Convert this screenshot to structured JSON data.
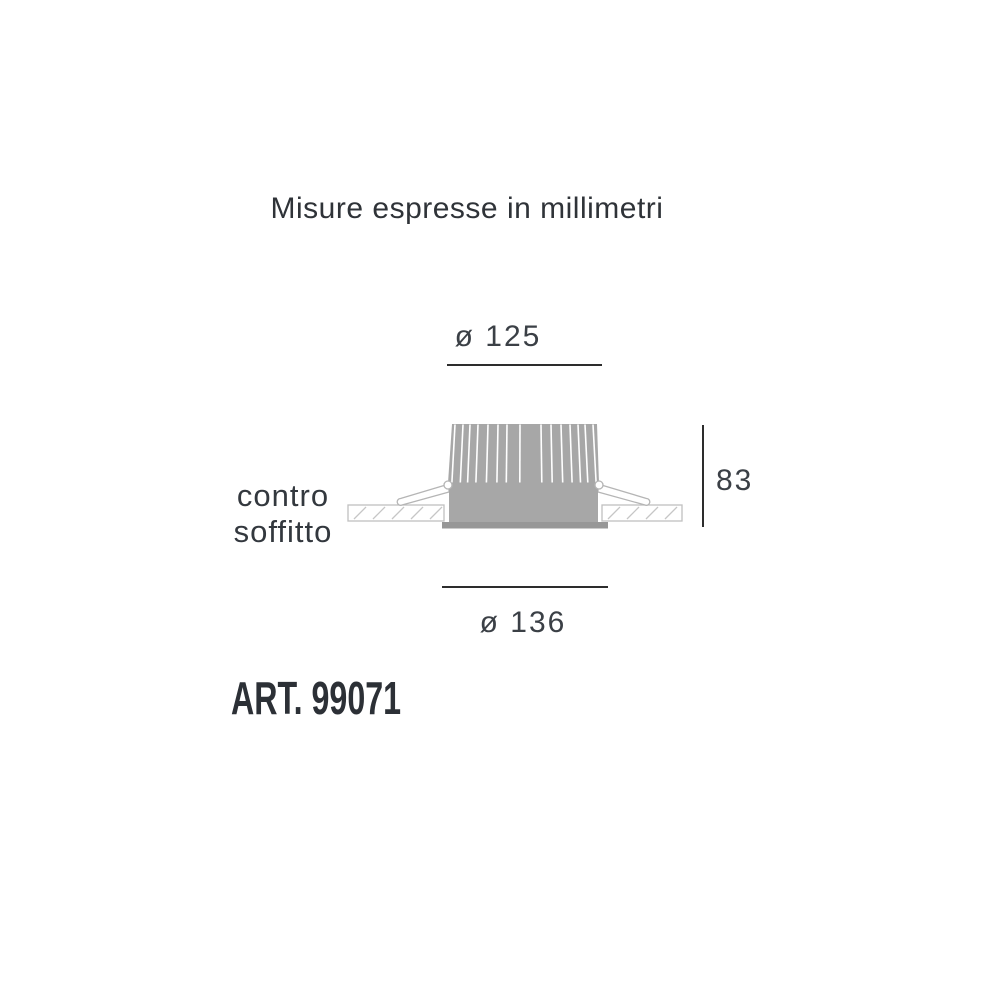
{
  "title": "Misure espresse in millimetri",
  "diagram": {
    "type": "technical-drawing",
    "subject": "recessed-downlight-cross-section",
    "dimensions": {
      "top_diameter": "ø 125",
      "height": "83",
      "bottom_diameter": "ø 136",
      "units": "millimetri"
    },
    "labels": {
      "ceiling_line1": "contro",
      "ceiling_line2": "soffitto"
    }
  },
  "article": {
    "label": "ART. 99071"
  },
  "colors": {
    "background": "#ffffff",
    "text": "#3b4046",
    "dimension_line": "#2d2d2d",
    "fixture_gray": "#a7a7a7",
    "flange_gray": "#979797",
    "outline_light_gray": "#bcbcbc",
    "hatch_gray": "#c6c6c6"
  }
}
